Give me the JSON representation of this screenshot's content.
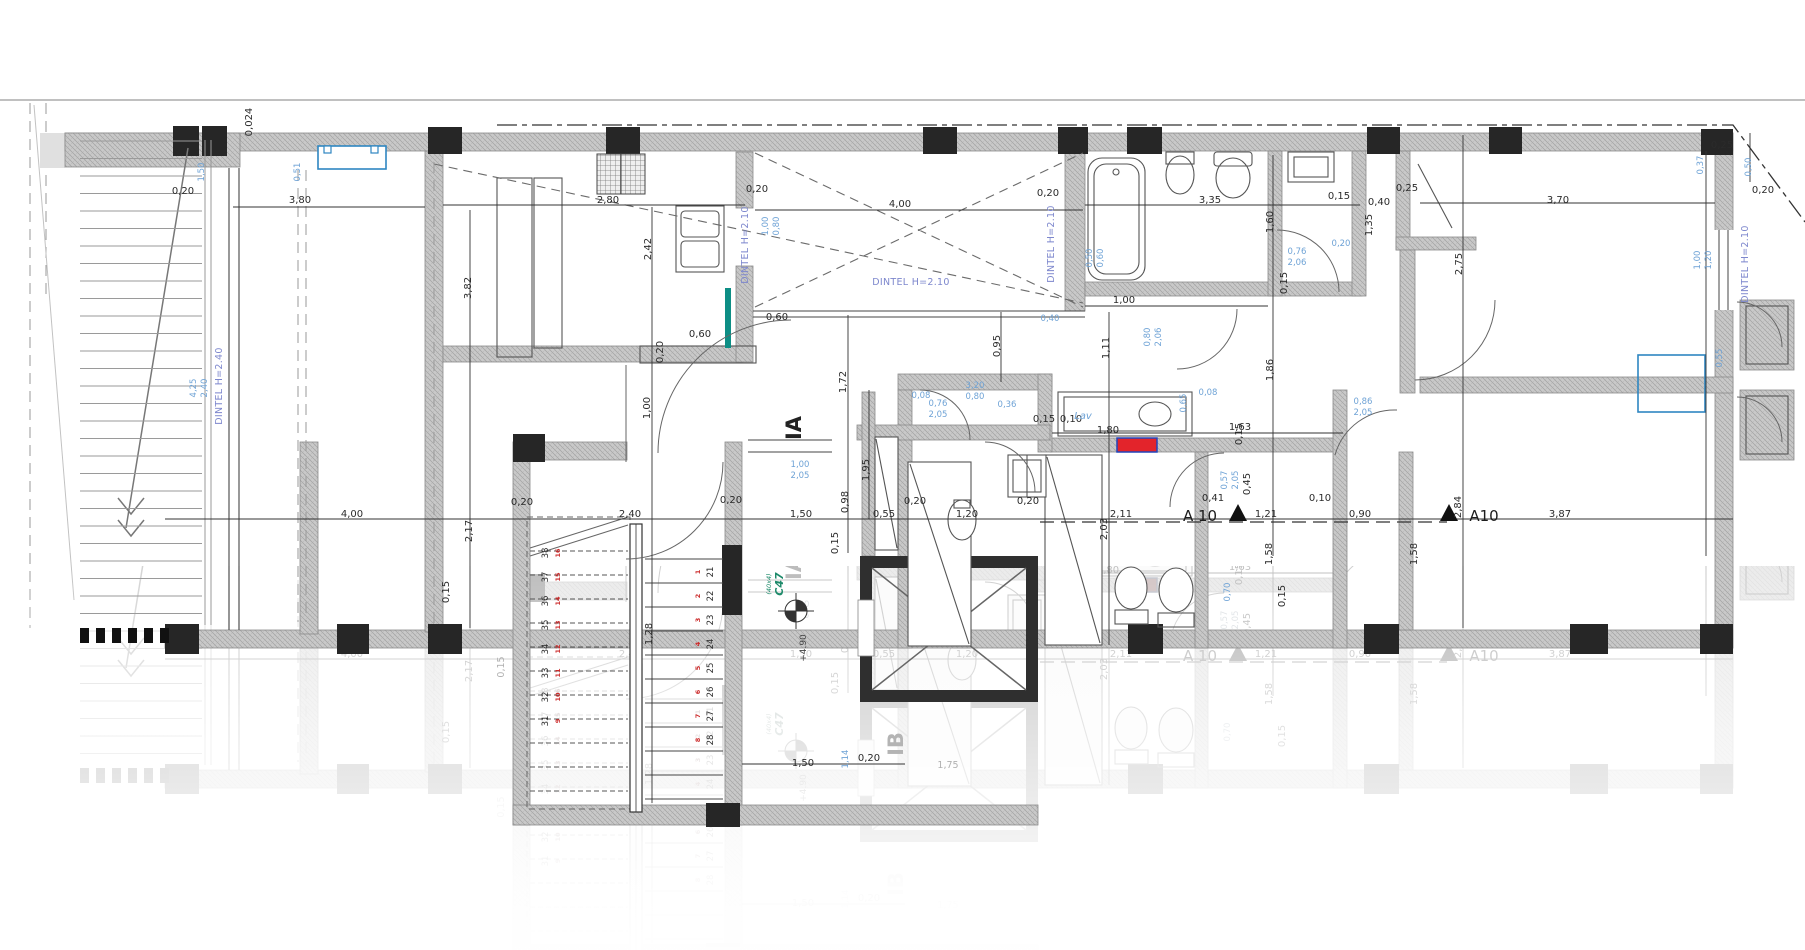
{
  "colors": {
    "dimension_black": "#2b2b2b",
    "opening_blue": "#6fa3d6",
    "lintel_blue": "#7d87cd",
    "column_green": "#1d8a6a",
    "step_red": "#cc2b2b",
    "highlight_red": "#e3242b",
    "highlight_border_blue": "#2244bb",
    "accent_teal": "#0d8e85",
    "window_blue": "#2e86c1",
    "wall_gray": "#c9c9c9",
    "ghost_gray": "#b4b4b4"
  },
  "annotations": [
    {
      "t": "0,024",
      "x": 252,
      "y": 122,
      "r": -90
    },
    {
      "t": "0,20",
      "x": 183,
      "y": 194
    },
    {
      "t": "3,80",
      "x": 300,
      "y": 203
    },
    {
      "t": "2,80",
      "x": 608,
      "y": 203
    },
    {
      "t": "0,20",
      "x": 757,
      "y": 192
    },
    {
      "t": "4,00",
      "x": 900,
      "y": 207
    },
    {
      "t": "0,20",
      "x": 1048,
      "y": 196
    },
    {
      "t": "3,35",
      "x": 1210,
      "y": 203
    },
    {
      "t": "0,15",
      "x": 1339,
      "y": 199
    },
    {
      "t": "0,25",
      "x": 1407,
      "y": 191
    },
    {
      "t": "0,40",
      "x": 1379,
      "y": 205
    },
    {
      "t": "3,70",
      "x": 1558,
      "y": 203
    },
    {
      "t": "0,20",
      "x": 1763,
      "y": 193
    },
    {
      "t": "0,25",
      "x": 1722,
      "y": 148
    },
    {
      "t": "3,82",
      "x": 471,
      "y": 288,
      "r": -90
    },
    {
      "t": "2,42",
      "x": 651,
      "y": 249,
      "r": -90
    },
    {
      "t": "0,60",
      "x": 700,
      "y": 337
    },
    {
      "t": "0,60",
      "x": 777,
      "y": 320
    },
    {
      "t": "0,20",
      "x": 663,
      "y": 352,
      "r": -90
    },
    {
      "t": "1,00",
      "x": 650,
      "y": 408,
      "r": -90
    },
    {
      "t": "0,95",
      "x": 1000,
      "y": 346,
      "r": -90
    },
    {
      "t": "1,11",
      "x": 1109,
      "y": 348,
      "r": -90
    },
    {
      "t": "1,00",
      "x": 1124,
      "y": 303
    },
    {
      "t": "1,60",
      "x": 1273,
      "y": 222,
      "r": -90
    },
    {
      "t": "0,15",
      "x": 1287,
      "y": 283,
      "r": -90
    },
    {
      "t": "1,35",
      "x": 1372,
      "y": 225,
      "r": -90
    },
    {
      "t": "2,75",
      "x": 1462,
      "y": 264,
      "r": -90
    },
    {
      "t": "1,86",
      "x": 1273,
      "y": 370,
      "r": -90
    },
    {
      "t": "1,72",
      "x": 846,
      "y": 382,
      "r": -90
    },
    {
      "t": "1,95",
      "x": 869,
      "y": 470,
      "r": -90
    },
    {
      "t": "2,03",
      "x": 1107,
      "y": 529,
      "r": -90
    },
    {
      "t": "1,80",
      "x": 1108,
      "y": 433
    },
    {
      "t": "1,63",
      "x": 1240,
      "y": 430
    },
    {
      "t": "0,10",
      "x": 1071,
      "y": 422
    },
    {
      "t": "0,15",
      "x": 1044,
      "y": 422
    },
    {
      "t": "4,00",
      "x": 352,
      "y": 517
    },
    {
      "t": "0,20",
      "x": 522,
      "y": 505
    },
    {
      "t": "2,40",
      "x": 630,
      "y": 517
    },
    {
      "t": "0,20",
      "x": 731,
      "y": 503
    },
    {
      "t": "1,50",
      "x": 801,
      "y": 517
    },
    {
      "t": "0,98",
      "x": 848,
      "y": 502,
      "r": -90
    },
    {
      "t": "0,15",
      "x": 838,
      "y": 543,
      "r": -90
    },
    {
      "t": "0,55",
      "x": 884,
      "y": 517
    },
    {
      "t": "0,20",
      "x": 915,
      "y": 504
    },
    {
      "t": "1,20",
      "x": 967,
      "y": 517
    },
    {
      "t": "0,20",
      "x": 1028,
      "y": 504
    },
    {
      "t": "2,11",
      "x": 1121,
      "y": 517
    },
    {
      "t": "0,41",
      "x": 1213,
      "y": 501
    },
    {
      "t": "1,21",
      "x": 1266,
      "y": 517
    },
    {
      "t": "0,10",
      "x": 1320,
      "y": 501
    },
    {
      "t": "0,90",
      "x": 1360,
      "y": 517
    },
    {
      "t": "3,87",
      "x": 1560,
      "y": 517
    },
    {
      "t": "2,84",
      "x": 1461,
      "y": 507,
      "r": -90
    },
    {
      "t": "0,45",
      "x": 1250,
      "y": 484,
      "r": -90
    },
    {
      "t": "0,15",
      "x": 1242,
      "y": 434,
      "r": -90
    },
    {
      "t": "1,58",
      "x": 1272,
      "y": 554,
      "r": -90
    },
    {
      "t": "1,58",
      "x": 1417,
      "y": 554,
      "r": -90
    },
    {
      "t": "2,17",
      "x": 472,
      "y": 531,
      "r": -90
    },
    {
      "t": "1,28",
      "x": 652,
      "y": 634,
      "r": -90
    },
    {
      "t": "1,50",
      "x": 803,
      "y": 766
    },
    {
      "t": "0,20",
      "x": 869,
      "y": 761
    },
    {
      "t": "0,15",
      "x": 449,
      "y": 592,
      "r": -90
    },
    {
      "t": "0,15",
      "x": 1285,
      "y": 596,
      "r": -90
    },
    {
      "t": "0,15",
      "x": 504,
      "y": 667,
      "c": "faded",
      "r": -90
    },
    {
      "t": "1,75",
      "x": 948,
      "y": 768,
      "c": "faded"
    },
    {
      "t": "1,50",
      "x": 204,
      "y": 172,
      "r": -90,
      "c": "blue"
    },
    {
      "t": "0,51",
      "x": 300,
      "y": 172,
      "r": -90,
      "c": "blue"
    },
    {
      "t": "4,25",
      "x": 196,
      "y": 388,
      "r": -90,
      "c": "blue"
    },
    {
      "t": "2,40",
      "x": 207,
      "y": 388,
      "r": -90,
      "c": "blue"
    },
    {
      "t": "1,00",
      "x": 768,
      "y": 226,
      "r": -90,
      "c": "blue"
    },
    {
      "t": "0,80",
      "x": 779,
      "y": 226,
      "r": -90,
      "c": "blue"
    },
    {
      "t": "3,20",
      "x": 975,
      "y": 388,
      "c": "blue"
    },
    {
      "t": "0,80",
      "x": 975,
      "y": 399,
      "c": "blue"
    },
    {
      "t": "0,08",
      "x": 921,
      "y": 398,
      "c": "blue"
    },
    {
      "t": "0,76",
      "x": 938,
      "y": 406,
      "c": "blue"
    },
    {
      "t": "2,05",
      "x": 938,
      "y": 417,
      "c": "blue"
    },
    {
      "t": "0,36",
      "x": 1007,
      "y": 407,
      "c": "blue"
    },
    {
      "t": "1,00",
      "x": 800,
      "y": 467,
      "c": "blue"
    },
    {
      "t": "2,05",
      "x": 800,
      "y": 478,
      "c": "blue"
    },
    {
      "t": "0,40",
      "x": 1050,
      "y": 321,
      "c": "blue"
    },
    {
      "t": "0,50",
      "x": 1092,
      "y": 258,
      "r": -90,
      "c": "blue"
    },
    {
      "t": "0,60",
      "x": 1103,
      "y": 258,
      "r": -90,
      "c": "blue"
    },
    {
      "t": "0,80",
      "x": 1150,
      "y": 337,
      "r": -90,
      "c": "blue"
    },
    {
      "t": "2,06",
      "x": 1161,
      "y": 337,
      "r": -90,
      "c": "blue"
    },
    {
      "t": "0,76",
      "x": 1297,
      "y": 254,
      "c": "blue"
    },
    {
      "t": "2,06",
      "x": 1297,
      "y": 265,
      "c": "blue"
    },
    {
      "t": "0,20",
      "x": 1341,
      "y": 246,
      "c": "blue"
    },
    {
      "t": "0,86",
      "x": 1363,
      "y": 404,
      "c": "blue"
    },
    {
      "t": "2,05",
      "x": 1363,
      "y": 415,
      "c": "blue"
    },
    {
      "t": "0,08",
      "x": 1208,
      "y": 395,
      "c": "blue"
    },
    {
      "t": "0,57",
      "x": 1227,
      "y": 480,
      "r": -90,
      "c": "blue"
    },
    {
      "t": "2,05",
      "x": 1238,
      "y": 480,
      "r": -90,
      "c": "blue"
    },
    {
      "t": "0,65",
      "x": 1186,
      "y": 403,
      "r": -90,
      "c": "blue"
    },
    {
      "t": "0,37",
      "x": 1703,
      "y": 165,
      "r": -90,
      "c": "blue"
    },
    {
      "t": "1,00",
      "x": 1700,
      "y": 260,
      "r": -90,
      "c": "blue"
    },
    {
      "t": "1,20",
      "x": 1711,
      "y": 260,
      "r": -90,
      "c": "blue"
    },
    {
      "t": "0,55",
      "x": 1722,
      "y": 358,
      "r": -90,
      "c": "blue"
    },
    {
      "t": "0,50",
      "x": 1751,
      "y": 167,
      "r": -90,
      "c": "blue"
    },
    {
      "t": "1,14",
      "x": 848,
      "y": 759,
      "r": -90,
      "c": "blue"
    },
    {
      "t": "0,70",
      "x": 1230,
      "y": 592,
      "r": -90,
      "c": "blue"
    },
    {
      "t": "DINTEL H=2.40",
      "x": 222,
      "y": 386,
      "r": -90,
      "c": "dintel"
    },
    {
      "t": "DINTEL H=2.10",
      "x": 748,
      "y": 245,
      "r": -90,
      "c": "dintel"
    },
    {
      "t": "DINTEL H=2.10",
      "x": 911,
      "y": 285,
      "c": "dintel"
    },
    {
      "t": "DINTEL H=2.10",
      "x": 1054,
      "y": 244,
      "r": -90,
      "c": "dintel"
    },
    {
      "t": "DINTEL H=2.10",
      "x": 1748,
      "y": 264,
      "r": -90,
      "c": "dintel"
    },
    {
      "t": "IA",
      "x": 801,
      "y": 428,
      "r": -90,
      "c": "unit"
    },
    {
      "t": "IB",
      "x": 903,
      "y": 744,
      "r": -90,
      "c": "unitGhost"
    },
    {
      "t": "C47",
      "x": 783,
      "y": 584,
      "r": -90,
      "c": "green"
    },
    {
      "t": "(40x4)",
      "x": 771,
      "y": 584,
      "r": -90,
      "c": "greensm"
    },
    {
      "t": "A 10",
      "x": 1200,
      "y": 521,
      "c": "sec"
    },
    {
      "t": "A10",
      "x": 1484,
      "y": 521,
      "c": "sec"
    },
    {
      "t": "Lav",
      "x": 1083,
      "y": 419,
      "c": "lav"
    },
    {
      "t": "+4.90",
      "x": 806,
      "y": 648,
      "r": -90,
      "c": "lvl"
    }
  ],
  "stair": {
    "right_black": [
      "21",
      "22",
      "23",
      "24",
      "25",
      "26",
      "27",
      "28"
    ],
    "right_red": [
      "1",
      "2",
      "3",
      "4",
      "5",
      "6",
      "7",
      "8"
    ],
    "left_black": [
      "38",
      "37",
      "36",
      "35",
      "34",
      "33",
      "32",
      "31"
    ],
    "left_red": [
      "16",
      "15",
      "14",
      "13",
      "12",
      "11",
      "10",
      "9"
    ]
  }
}
